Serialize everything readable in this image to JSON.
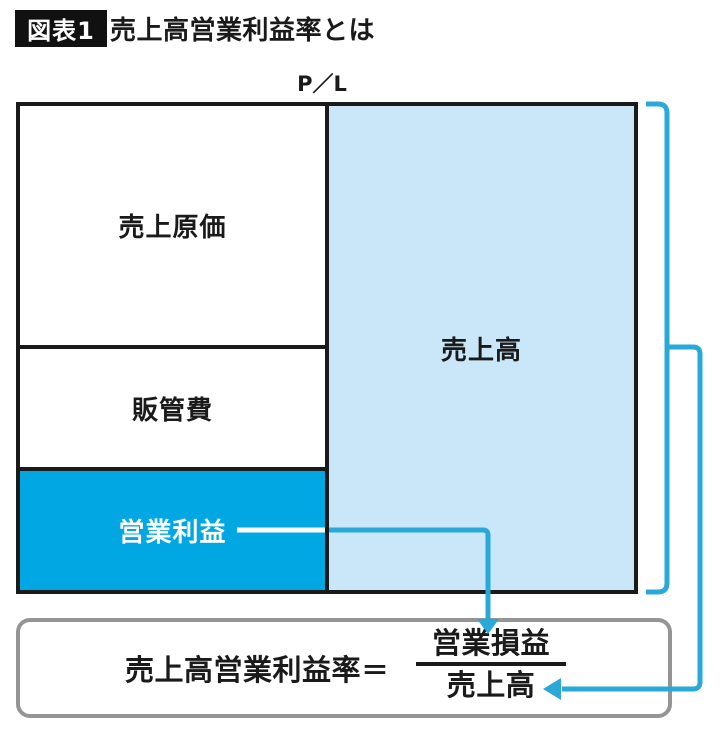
{
  "header": {
    "badge": "図表1",
    "title": "売上高営業利益率とは"
  },
  "chart": {
    "axis_label": "P／L",
    "left_column": [
      {
        "label": "売上原価"
      },
      {
        "label": "販管費"
      },
      {
        "label": "営業利益"
      }
    ],
    "right_column": {
      "label": "売上高"
    }
  },
  "formula": {
    "lhs": "売上高営業利益率",
    "equals": "＝",
    "numerator": "営業損益",
    "denominator": "売上高"
  },
  "colors": {
    "accent_blue": "#00a7e3",
    "light_blue": "#c9e7f9",
    "line_blue": "#2aa8d8",
    "border_dark": "#1a1a1a",
    "box_border_gray": "#949494",
    "badge_bg": "#111111",
    "badge_text": "#ffffff"
  }
}
